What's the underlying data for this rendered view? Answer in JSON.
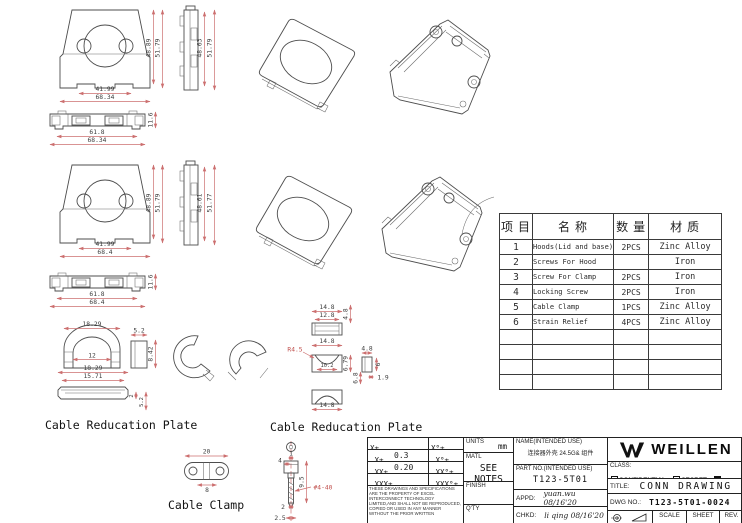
{
  "drawings": {
    "hood_a": {
      "front": {
        "w1": "41.99",
        "w2": "68.34",
        "h1": "48.89",
        "h2": "51.79"
      },
      "side": {
        "h1": "48.63",
        "h2": "51.79"
      },
      "bottom": {
        "w1": "61.8",
        "w2": "68.34",
        "h": "11.6"
      }
    },
    "hood_b": {
      "front": {
        "w1": "41.99",
        "w2": "68.4",
        "h1": "48.89",
        "h2": "51.79"
      },
      "side": {
        "h1": "48.61",
        "h2": "51.77"
      },
      "bottom": {
        "w1": "61.8",
        "w2": "68.4",
        "h": "11.6"
      }
    },
    "plate_a": {
      "label": "Cable Reducation Plate",
      "top_w": "18.29",
      "top_inner": "12",
      "side_w": "5.2",
      "side_h": "8.42",
      "flat_w": "18.29",
      "flat_inner": "15.71",
      "flat_t": "2",
      "flat_h": "5.2"
    },
    "plate_b": {
      "label": "Cable Reducation Plate",
      "top_w": "14.8",
      "top_inner": "12.8",
      "top_h": "4.8",
      "radius": "R4.5",
      "mid_w": "14.8",
      "mid_inner": "10.2",
      "mid_h": "6.79",
      "side_w": "4.8",
      "side_h": "6",
      "side_h2": "6.8",
      "side_t": "1.9",
      "bot_w": "14.8"
    },
    "clamp": {
      "label": "Cable Clamp",
      "w": "20",
      "hole_span": "8"
    },
    "screw": {
      "shaft_w": "1",
      "head_w": "4",
      "len": "9.5",
      "thread": "#4-40",
      "t1": "2",
      "t2": "2.5"
    }
  },
  "parts_table": {
    "headers": [
      "项 目",
      "名 称",
      "数 量",
      "材 质"
    ],
    "rows": [
      [
        "1",
        "Hoods(Lid and base)",
        "2PCS",
        "Zinc Alloy"
      ],
      [
        "2",
        "Screws For Hood",
        "",
        "Iron"
      ],
      [
        "3",
        "Screw For Clamp",
        "2PCS",
        "Iron"
      ],
      [
        "4",
        "Locking Screw",
        "2PCS",
        "Iron"
      ],
      [
        "5",
        "Cable Clamp",
        "1PCS",
        "Zinc Alloy"
      ],
      [
        "6",
        "Strain Relief",
        "4PCS",
        "Zinc Alloy"
      ]
    ]
  },
  "title_block": {
    "tolerance_linear": [
      {
        "label": "X±",
        "value": ""
      },
      {
        "label": ".X±",
        "value": "0.3"
      },
      {
        "label": ".XX±",
        "value": "0.20"
      },
      {
        "label": ".XXX±",
        "value": ""
      }
    ],
    "tolerance_angular": [
      "X°±",
      ".X°±",
      ".XX°±",
      ".XXX°±"
    ],
    "disclaimer": "THESE DRAWINGS AND SPECIFICATIONS ARE THE PROPERTY OF EXCEL INTERCONNECT TECHNOLOGY LIMITED,AND SHALL NOT BE REPRODUCED, COPIED OR USED IN ANY MANNER WITHOUT THE PRIOR WRITTEN",
    "units_label": "UNITS",
    "units_value": "mm",
    "matl_label": "MATL",
    "matl_value": "SEE NOTES",
    "finish_label": "FINISH",
    "qty_label": "Q'TY",
    "name_label": "NAME(INTENDED USE)",
    "name_value": "连接器外壳 24.5G& 组件",
    "part_no_label": "PART NO.(INTENDED USE)",
    "part_no_value": "T123-5T01",
    "appd_label": "APPD:",
    "appd_value": "yuan.wu 08/16'20",
    "chkd_label": "CHKD:",
    "chkd_value": "li qing 08/16'20",
    "brand": "WEILLEN",
    "class_label": "CLASS:",
    "class_options": [
      {
        "label": "CONFIDENTIAL",
        "checked": false
      },
      {
        "label": "SECRET",
        "checked": false
      },
      {
        "label": "GENERAL",
        "checked": true
      }
    ],
    "title_label": "TITLE:",
    "title_value": "CONN DRAWING",
    "dwg_no_label": "DWG NO.:",
    "dwg_no_value": "T123-5T01-0024",
    "scale_label": "SCALE",
    "sheet_label": "SHEET",
    "rev_label": "REV.",
    "accent_dim_color": "#cc6f6f"
  }
}
